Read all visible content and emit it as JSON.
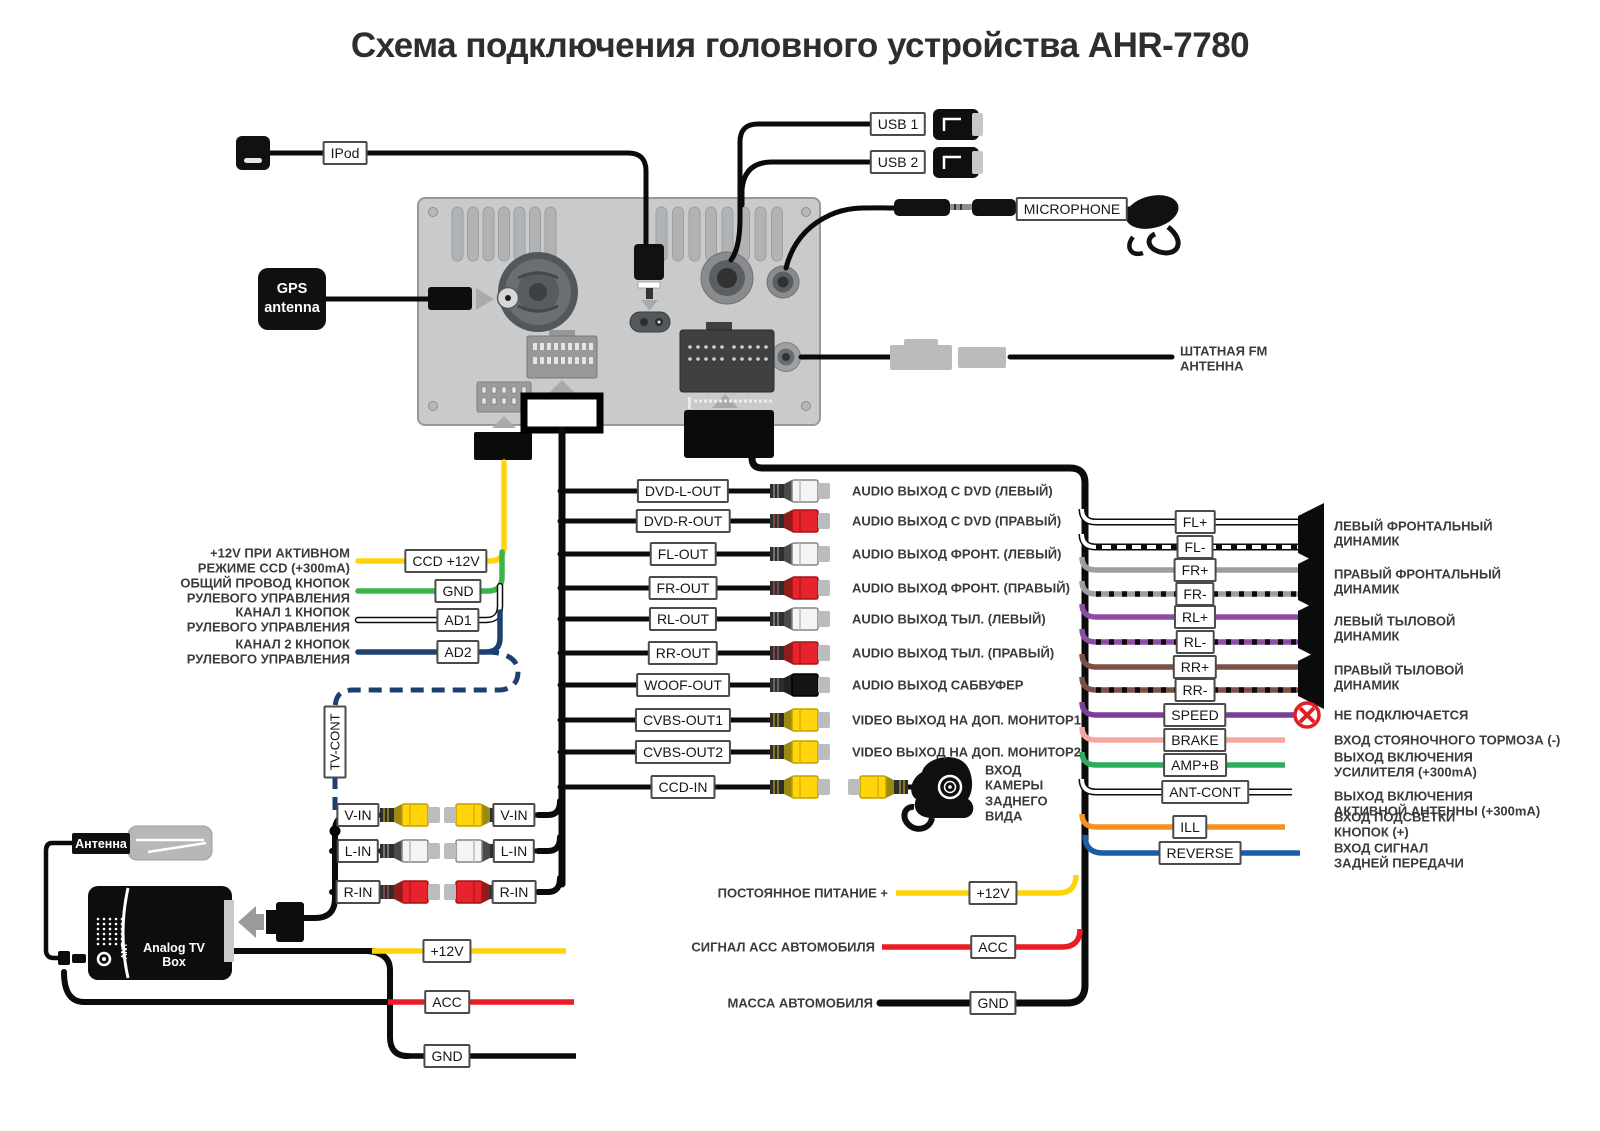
{
  "title": "Схема подключения головного устройства AHR-7780",
  "top": {
    "ipod": "IPod",
    "usb1": "USB 1",
    "usb2": "USB 2",
    "microphone": "MICROPHONE",
    "gps": "GPS\nantenna",
    "fm": "ШТАТНАЯ FM\nАНТЕННА"
  },
  "left_rows": [
    {
      "desc": "+12V ПРИ АКТИВНОМ\nРЕЖИМЕ CCD (+300mA)",
      "box": "CCD +12V",
      "color": "#FFD40A"
    },
    {
      "desc": "ОБЩИЙ ПРОВОД КНОПОК\nРУЛЕВОГО УПРАВЛЕНИЯ",
      "box": "GND",
      "color": "#3BB54A"
    },
    {
      "desc": "КАНАЛ 1 КНОПОК\nРУЛЕВОГО УПРАВЛЕНИЯ",
      "box": "AD1",
      "color": "white-outline"
    },
    {
      "desc": "КАНАЛ 2 КНОПОК\nРУЛЕВОГО УПРАВЛЕНИЯ",
      "box": "AD2",
      "color": "#1C4170"
    }
  ],
  "tv_cont": "TV-CONT",
  "center_rows": [
    {
      "box": "DVD-L-OUT",
      "rca": "white",
      "desc": "AUDIO ВЫХОД С DVD (ЛЕВЫЙ)"
    },
    {
      "box": "DVD-R-OUT",
      "rca": "red",
      "desc": "AUDIO ВЫХОД С DVD (ПРАВЫЙ)"
    },
    {
      "box": "FL-OUT",
      "rca": "white",
      "desc": "AUDIO ВЫХОД ФРОНТ. (ЛЕВЫЙ)"
    },
    {
      "box": "FR-OUT",
      "rca": "red",
      "desc": "AUDIO ВЫХОД ФРОНТ. (ПРАВЫЙ)"
    },
    {
      "box": "RL-OUT",
      "rca": "white",
      "desc": "AUDIO ВЫХОД ТЫЛ. (ЛЕВЫЙ)"
    },
    {
      "box": "RR-OUT",
      "rca": "red",
      "desc": "AUDIO ВЫХОД ТЫЛ. (ПРАВЫЙ)"
    },
    {
      "box": "WOOF-OUT",
      "rca": "black",
      "desc": "AUDIO ВЫХОД САБВУФЕР"
    },
    {
      "box": "CVBS-OUT1",
      "rca": "yellow",
      "desc": "VIDEO ВЫХОД НА ДОП. МОНИТОР1"
    },
    {
      "box": "CVBS-OUT2",
      "rca": "yellow",
      "desc": "VIDEO ВЫХОД НА ДОП. МОНИТОР2"
    },
    {
      "box": "CCD-IN",
      "rca": "yellow",
      "desc": ""
    }
  ],
  "camera_note": "ВХОД\nКАМЕРЫ\nЗАДНЕГО\nВИДА",
  "speaker_wires": [
    "FL+",
    "FL-",
    "FR+",
    "FR-",
    "RL+",
    "RL-",
    "RR+",
    "RR-"
  ],
  "speakers": [
    "ЛЕВЫЙ ФРОНТАЛЬНЫЙ\nДИНАМИК",
    "ПРАВЫЙ ФРОНТАЛЬНЫЙ\nДИНАМИК",
    "ЛЕВЫЙ ТЫЛОВОЙ\nДИНАМИК",
    "ПРАВЫЙ ТЫЛОВОЙ\nДИНАМИК"
  ],
  "tail_rows": [
    {
      "box": "SPEED",
      "desc": "НЕ ПОДКЛЮЧАЕТСЯ",
      "color": "#7C3E98"
    },
    {
      "box": "BRAKE",
      "desc": "ВХОД СТОЯНОЧНОГО ТОРМОЗА (-)",
      "color": "#F5A8A2"
    },
    {
      "box": "AMP+B",
      "desc": "ВЫХОД ВКЛЮЧЕНИЯ\nУСИЛИТЕЛЯ (+300mA)",
      "color": "#2BAD5E"
    },
    {
      "box": "ANT-CONT",
      "desc": "ВЫХОД ВКЛЮЧЕНИЯ\nАКТИВНОЙ АНТЕННЫ (+300mA)",
      "color": "white-outline"
    },
    {
      "box": "ILL",
      "desc": "ВХОД ПОДСВЕТКИ\nКНОПОК (+)",
      "color": "#F6921E"
    },
    {
      "box": "REVERSE",
      "desc": "ВХОД СИГНАЛ\nЗАДНЕЙ ПЕРЕДАЧИ",
      "color": "#1A5DA6"
    }
  ],
  "power_rows": [
    {
      "desc": "ПОСТОЯННОЕ ПИТАНИЕ +",
      "box": "+12V",
      "color": "#FFD40A"
    },
    {
      "desc": "СИГНАЛ ACC АВТОМОБИЛЯ",
      "box": "ACC",
      "color": "#EC1C24"
    },
    {
      "desc": "МАССА АВТОМОБИЛЯ",
      "box": "GND",
      "color": "#0B0B0B"
    }
  ],
  "av_rows": [
    {
      "left": "V-IN",
      "right": "V-IN",
      "rca": "yellow"
    },
    {
      "left": "L-IN",
      "right": "L-IN",
      "rca": "white"
    },
    {
      "left": "R-IN",
      "right": "R-IN",
      "rca": "red"
    }
  ],
  "tv_section": {
    "antenna": "Антенна",
    "box": "Analog TV Box",
    "ant": "ANT",
    "rows": [
      {
        "box": "+12V",
        "color": "#FFD40A"
      },
      {
        "box": "ACC",
        "color": "#EC1C24"
      },
      {
        "box": "GND",
        "color": "#0B0B0B"
      }
    ]
  },
  "wire_colors": {
    "yellow": "#FFD40A",
    "green": "#3BB54A",
    "navy": "#1C4170",
    "blue": "#1A5DA6",
    "red": "#EC1C24",
    "pink": "#F5A8A2",
    "orange": "#F6921E",
    "purple_speed": "#7C3E98",
    "purple_rl": "#8E4DA5",
    "brown_rr": "#7D4F46",
    "gray_fr": "#9C9EA0",
    "amp_green": "#2BAD5E",
    "black": "#0B0B0B",
    "no_connect_red": "#E31E24"
  }
}
